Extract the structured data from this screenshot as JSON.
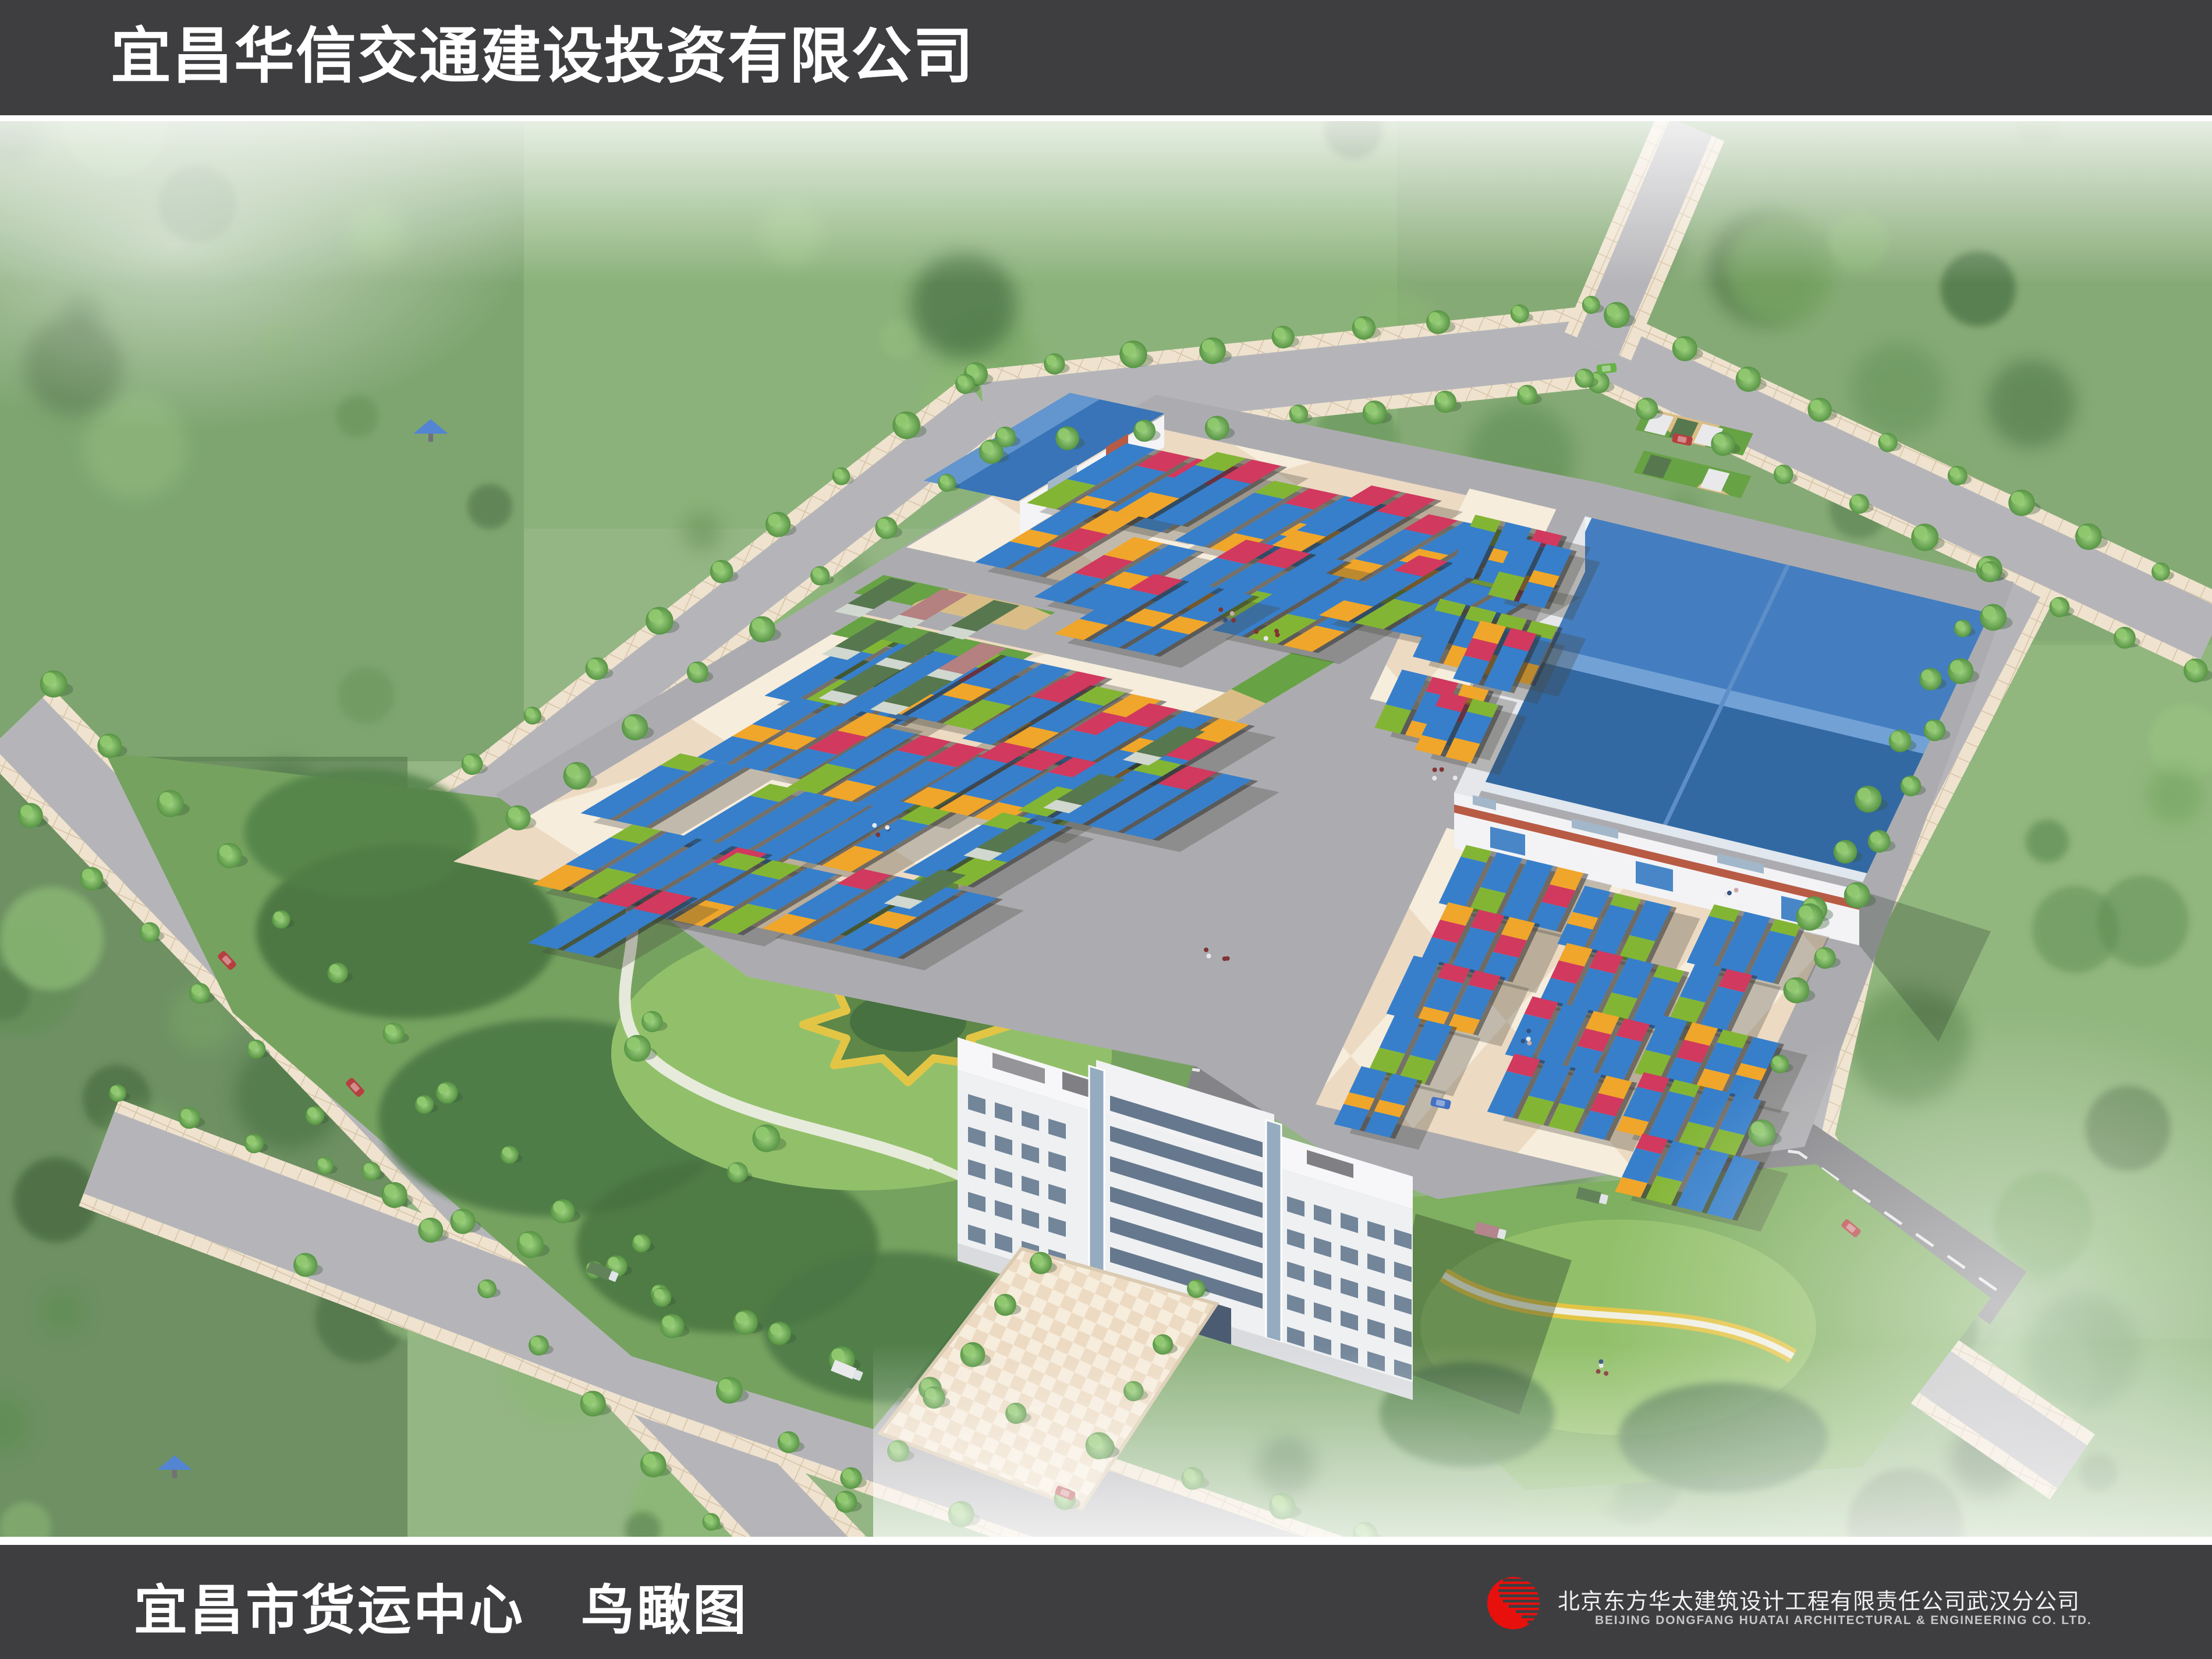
{
  "header": {
    "company_title": "宜昌华信交通建设投资有限公司"
  },
  "footer": {
    "drawing_title": "宜昌市货运中心　鸟瞰图",
    "logo": "red-striped-globe-logo",
    "company_cn": "北京东方华太建筑设计工程有限责任公司武汉分公司",
    "company_en": "BEIJING DONGFANG HUATAI ARCHITECTURAL & ENGINEERING CO. LTD."
  },
  "colors": {
    "banner": "#3e3e41",
    "banner_text": "#ffffff",
    "footer_en_text": "#c6c6c6",
    "logo_red": "#e8100c"
  },
  "scene": {
    "type": "architectural-aerial-rendering",
    "subject": "freight logistics center bird's-eye view with container yard, warehouse, office building, parks and tree-lined roads",
    "container_colors": {
      "blue": "#2d79c8",
      "green": "#7db22b",
      "orange": "#f0a21f",
      "red": "#cf2f56"
    },
    "warehouse_roof": "#2f6fb5",
    "warehouse_roof_dark": "#27619f",
    "accent_red_band": "#b5533c",
    "pavement": "#f6ecdb",
    "pavement_alt": "#ecd9c0",
    "apron": "#a8a8ac",
    "road": "#b2b2b6",
    "road_side": "#e8dcc6",
    "dark_road": "#7e7e82",
    "grass_paver_green": "#5f9e3c",
    "grass_paver_tan": "#d8ba80",
    "forest": "#5d8a50",
    "park_lawn": "#8dbd63",
    "flowerbed_yellow": "#e2c23c",
    "office_wall": "#eef0f2",
    "office_glass": "#8fa7bd",
    "haze": "#ffffff"
  }
}
